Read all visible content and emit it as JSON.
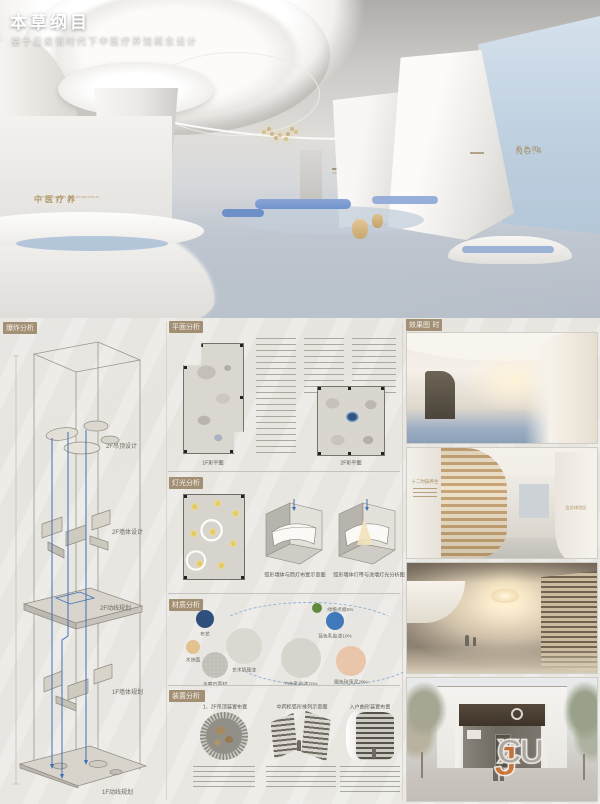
{
  "poster": {
    "title": "本草纲目",
    "subtitle": "基于后疫情时代下中医疗养馆概念设计"
  },
  "hero": {
    "desk_sign": "中医疗养",
    "desk_sign_sub": "Herb Regimen and Acupuncture",
    "wall_area_label": "养生阁",
    "wall_area_no": "NO.4"
  },
  "sections": {
    "explode": {
      "index": "柒·午时",
      "title": "爆炸分析",
      "labels": [
        "2F吊顶设计",
        "2F墙体设计",
        "2F动线规划",
        "1F墙体规划",
        "1F动线规划"
      ]
    },
    "plan": {
      "index": "捌·未时",
      "title": "平面分析",
      "caption_1f": "1F彩平图",
      "caption_2f": "2F彩平图"
    },
    "light": {
      "index": "玖·申时",
      "title": "灯光分析",
      "caption_a": "弧形墙体与筒灯布置示意图",
      "caption_b": "弧形墙体灯带与洗墙灯光分析图"
    },
    "material": {
      "index": "拾·酉时",
      "title": "材质分析",
      "items": [
        {
          "label": "布艺",
          "color": "#2f4f7c"
        },
        {
          "label": "木饰面",
          "color": "#e2c28e"
        },
        {
          "label": "水磨石面材",
          "color": "#c6c3bc"
        },
        {
          "label": "艺术肌理漆",
          "color": "#dbd8d2"
        },
        {
          "label": "白色乳胶漆70%",
          "color": "#d7d4ce"
        },
        {
          "label": "绿植点缀5%",
          "color": "#5f8a3e"
        },
        {
          "label": "蓝色乳胶漆10%",
          "color": "#4079bb"
        },
        {
          "label": "暖色硅藻泥20%",
          "color": "#e9c6a9"
        }
      ]
    },
    "device": {
      "index": "十一·戌时",
      "title": "装置分析",
      "caption_a": "1、2F吊顶装置布置",
      "caption_b": "中药柜弧形排列示意图",
      "caption_c": "入户曲形装置布置"
    },
    "renders": {
      "index": "十二·亥时",
      "title": "效果图",
      "wall_text_a": "十二时辰养生",
      "wall_text_b": "会员体验区"
    }
  },
  "watermark": {
    "p1": "XU",
    "p2": "J",
    "p3": "C"
  }
}
